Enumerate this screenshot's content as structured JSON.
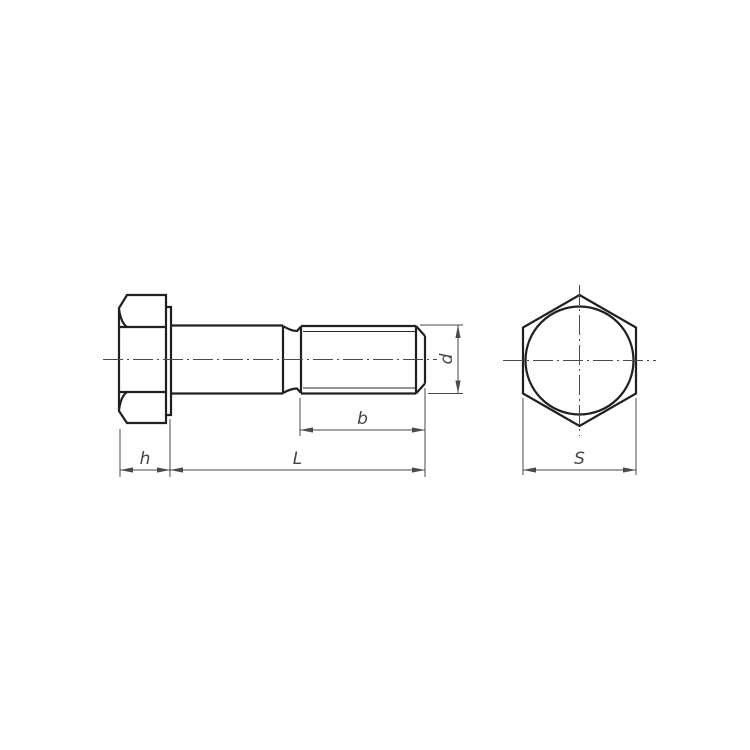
{
  "labels": {
    "h": "h",
    "L": "L",
    "b": "b",
    "d": "d",
    "S": "S"
  },
  "colors": {
    "outline": "#202022",
    "thin": "#2a2a2c",
    "dim": "#4a4a4e",
    "text": "#454549",
    "background": "#ffffff"
  }
}
